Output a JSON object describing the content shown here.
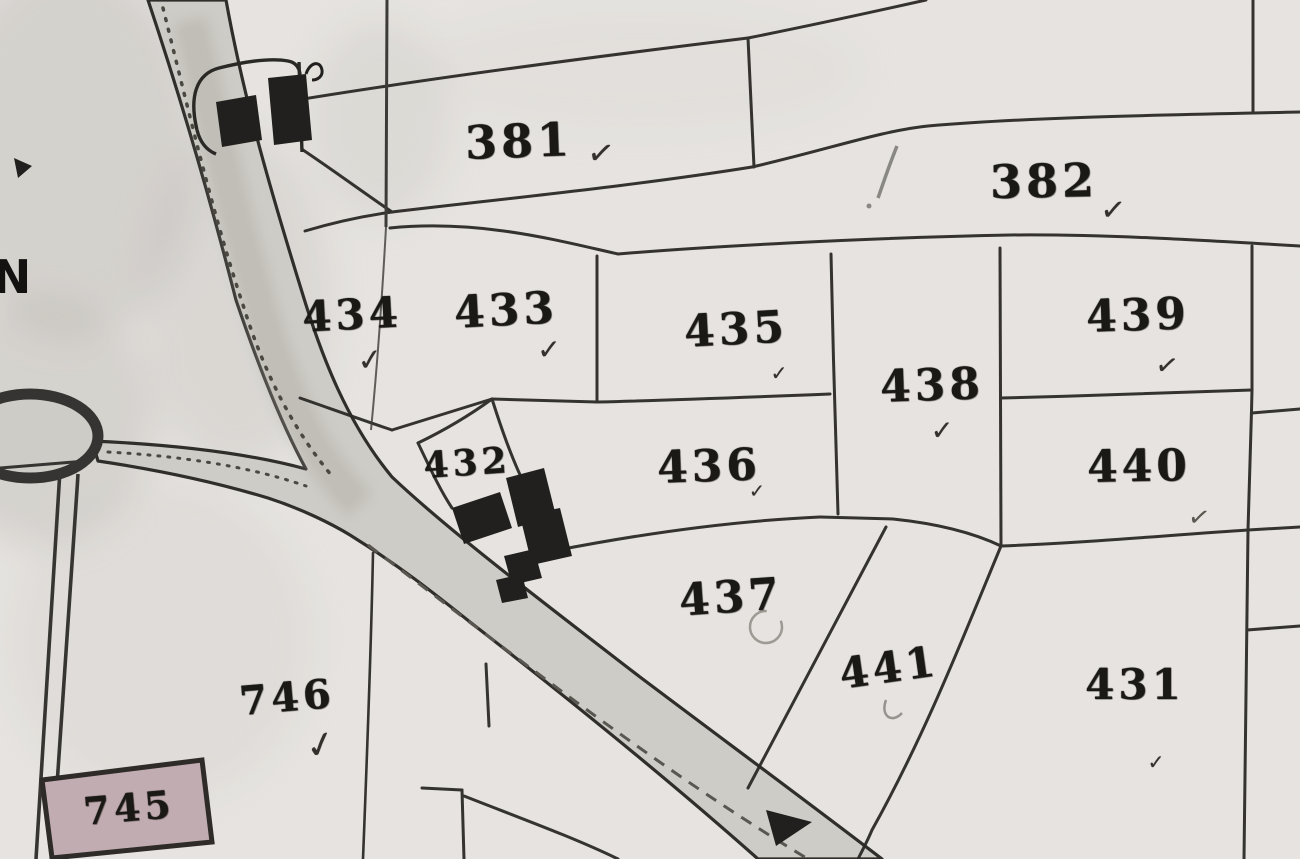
{
  "map": {
    "edge_label": "N",
    "colors": {
      "paper": "#f3f1ed",
      "ink": "#1e1c19",
      "road_fill": "#d8d6d0",
      "building_fill": "#141210",
      "building_745_fill": "#c9b2b8",
      "pencil_mark": "#8b8984"
    },
    "parcels": [
      {
        "number": "381",
        "check": "✓"
      },
      {
        "number": "382",
        "check": "✓"
      },
      {
        "number": "434",
        "check": "✓"
      },
      {
        "number": "433",
        "check": "✓"
      },
      {
        "number": "435",
        "check": "✓"
      },
      {
        "number": "436",
        "check": "✓"
      },
      {
        "number": "437",
        "check": ""
      },
      {
        "number": "438",
        "check": "✓"
      },
      {
        "number": "439",
        "check": "✓"
      },
      {
        "number": "440",
        "check": "✓"
      },
      {
        "number": "441",
        "check": ""
      },
      {
        "number": "431",
        "check": "✓"
      },
      {
        "number": "432",
        "check": ""
      },
      {
        "number": "746",
        "check": "✓"
      },
      {
        "number": "745",
        "check": ""
      }
    ]
  }
}
